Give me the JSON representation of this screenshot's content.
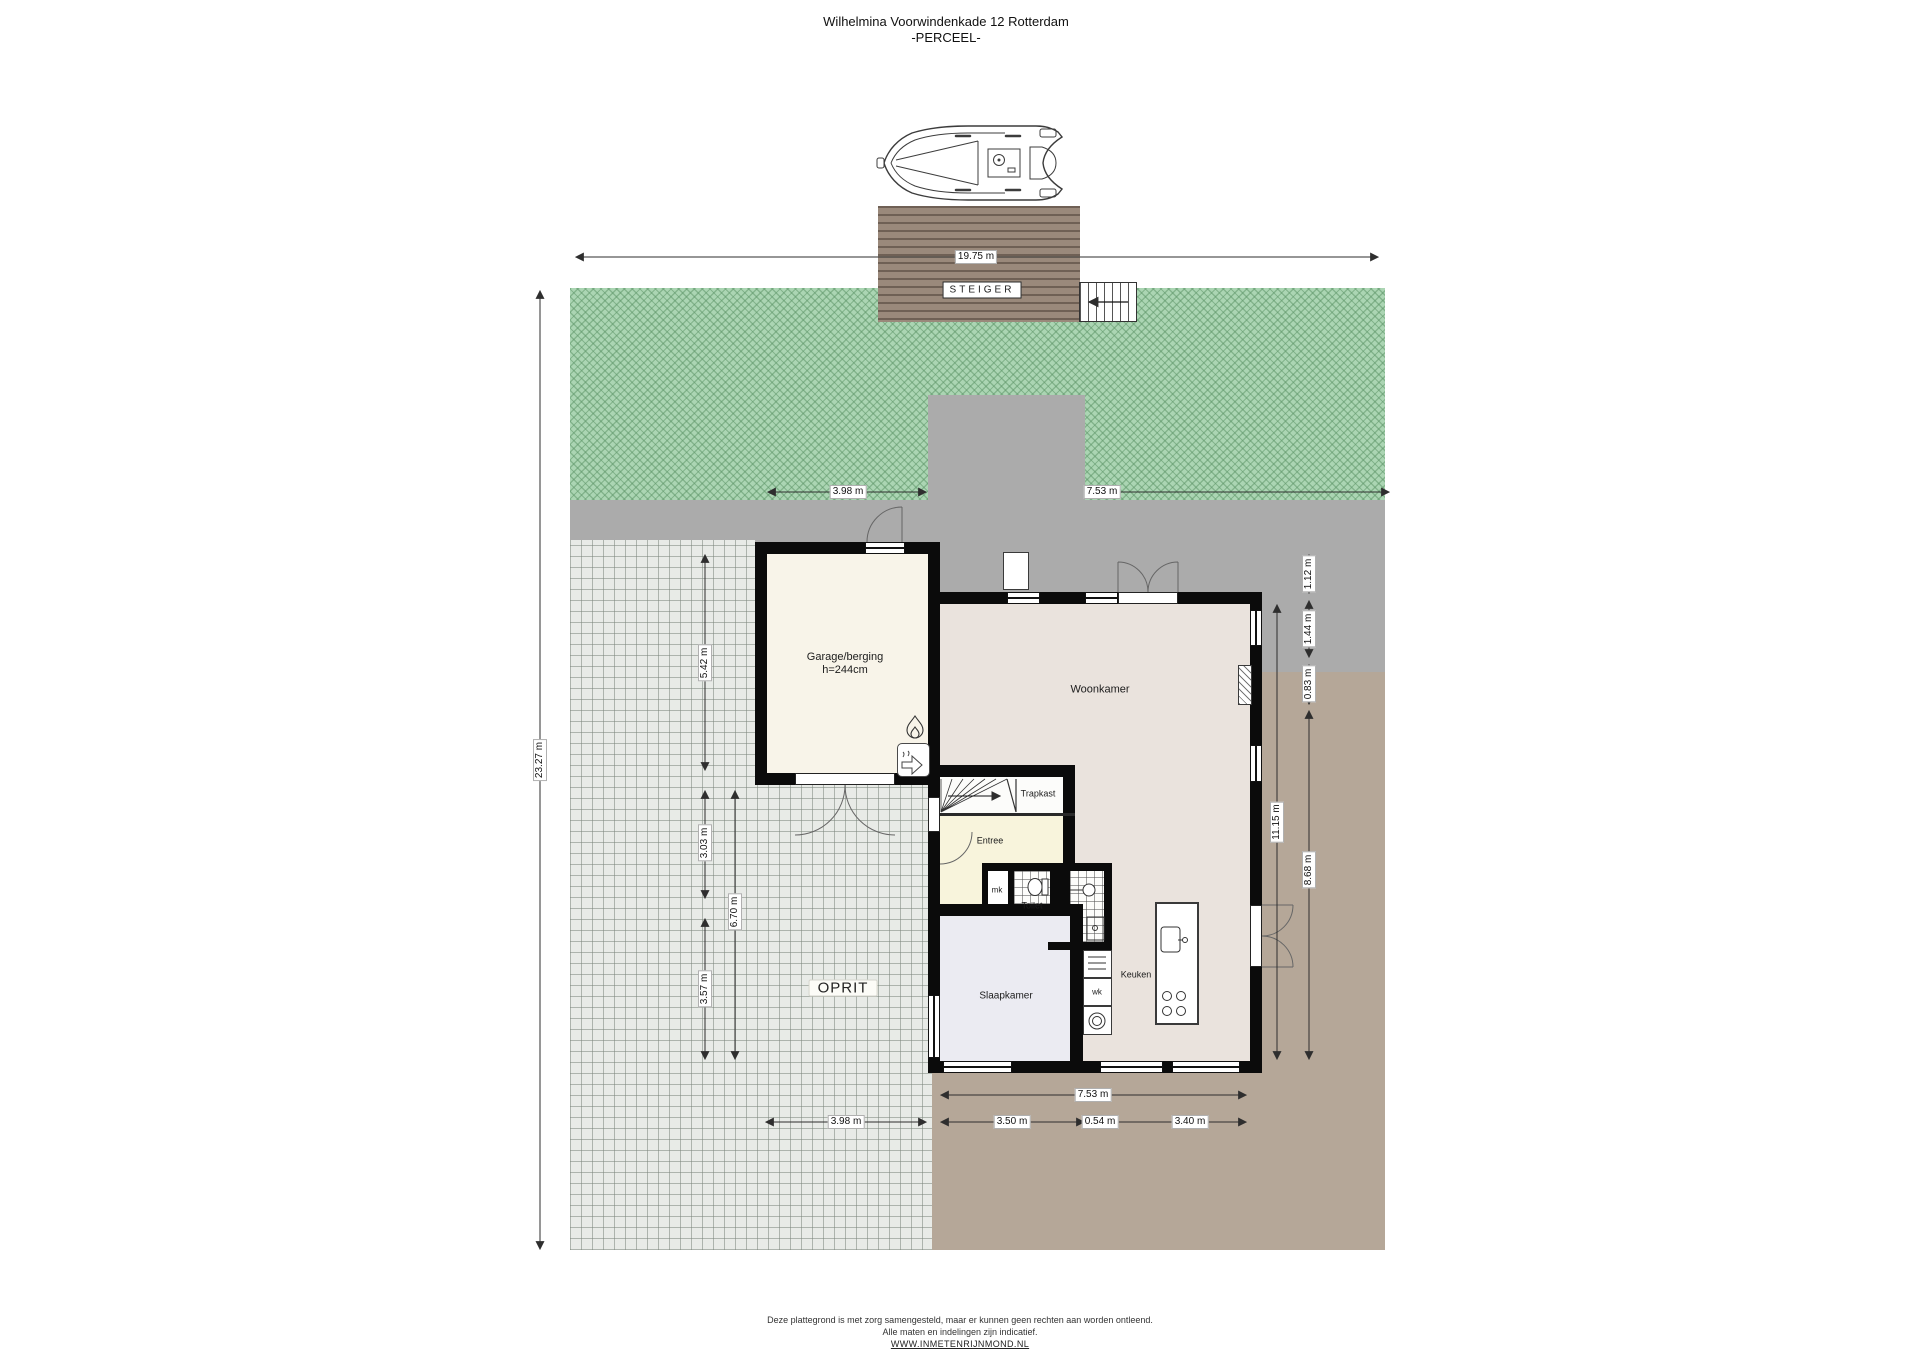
{
  "title": {
    "line1": "Wilhelmina Voorwindenkade 12 Rotterdam",
    "line2": "-PERCEEL-"
  },
  "site": {
    "steiger_label": "STEIGER",
    "oprit_label": "OPRIT"
  },
  "rooms": {
    "garage_name": "Garage/berging",
    "garage_height": "h=244cm",
    "woonkamer": "Woonkamer",
    "trapkast": "Trapkast",
    "entree": "Entree",
    "mk": "mk",
    "toilet": "Toilet",
    "keuken": "Keuken",
    "wk": "wk",
    "slaapkamer": "Slaapkamer"
  },
  "dims": {
    "plot_width": "19.75 m",
    "plot_depth": "23.27 m",
    "garage_width_top": "3.98 m",
    "terrace_top": "7.53 m",
    "garage_depth": "5.42 m",
    "left_mid": "3.03 m",
    "left_low": "3.57 m",
    "left_total": "6.70 m",
    "right_top_a": "1.12 m",
    "right_top_b": "1.44 m",
    "right_top_c": "0.83 m",
    "right_house": "11.15 m",
    "right_low": "8.68 m",
    "bottom_house": "7.53 m",
    "bottom_drive": "3.98 m",
    "bottom_a": "3.50 m",
    "bottom_b": "0.54 m",
    "bottom_c": "3.40 m"
  },
  "icons": {
    "boat": "boat-top-view-icon",
    "dock_stairs": "dock-stairs-icon",
    "flame": "boiler-flame-icon",
    "heatpump": "heat-pump-arrow-icon",
    "stairs": "staircase-fan-icon",
    "toilet": "toilet-fixture-icon",
    "washbasin": "washbasin-icon",
    "shower": "shower-tray-icon",
    "washer": "washing-machine-icon",
    "sink": "kitchen-sink-icon",
    "hob": "cooktop-burners-icon",
    "fireplace": "chimney-hatch-icon"
  },
  "colors": {
    "grass": "#abd5b3",
    "grass_hatch": "#5c9466",
    "pavement_gray": "#ababab",
    "driveway": "#e8ebe7",
    "terrace_brown": "#b5a798",
    "dock_wood": "#9a897b",
    "wall_black": "#0b0b0b",
    "garage_floor": "#f8f4e9",
    "livingroom_floor": "#eae3dd",
    "entree_floor": "#f8f4dc",
    "bedroom_floor": "#ebebf2"
  },
  "footer": {
    "line1": "Deze plattegrond is met zorg samengesteld, maar er kunnen geen rechten aan worden ontleend.",
    "line2": "Alle maten en indelingen zijn indicatief.",
    "line3": "WWW.INMETENRIJNMOND.NL"
  }
}
